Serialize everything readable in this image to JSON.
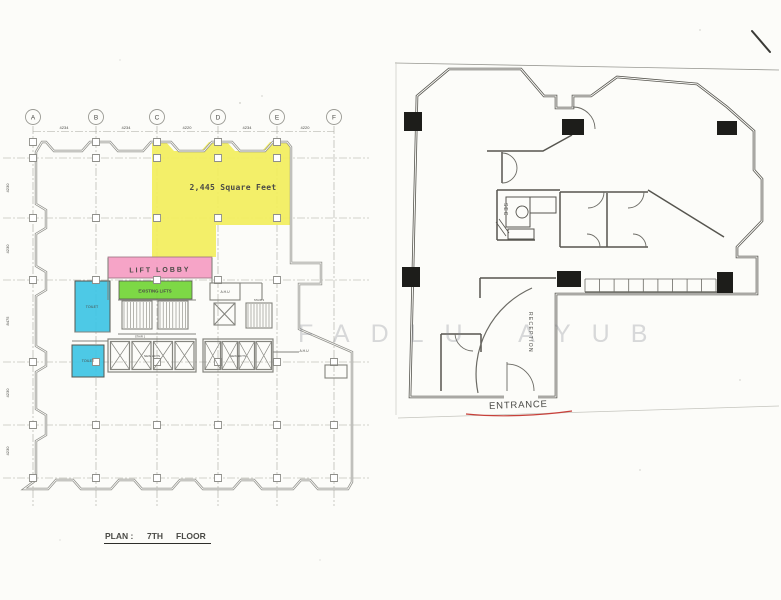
{
  "watermark": "FADLU AYUB",
  "left_plan": {
    "caption_prefix": "PLAN :",
    "caption_floor": "7TH",
    "caption_suffix": "FLOOR",
    "area_label": "2,445 Square Feet",
    "lift_lobby": "LIFT LOBBY",
    "existing_lifts": "EXISTING LIFTS",
    "toilet_upper": "TOILET",
    "toilet_lower": "TOILET",
    "ahu_upper": "A.H.U",
    "ahu_lower": "A.H.U",
    "stair_left": "STAIR 1",
    "stair_right": "STAIR 2",
    "lift_bank_left": "NEW LIFTS",
    "lift_bank_right": "NEW LIFTS",
    "grid_columns": [
      "A",
      "B",
      "C",
      "D",
      "E",
      "F"
    ],
    "top_dims": [
      "4234",
      "4234",
      "4220",
      "4234",
      "4220"
    ],
    "side_dims": [
      "4230",
      "4230",
      "8475",
      "4230",
      "4230"
    ]
  },
  "right_plan": {
    "sec": "SEC",
    "reception": "RECEPTION",
    "entrance": "ENTRANCE"
  },
  "colors": {
    "yellow": "#f2ee5c",
    "pink": "#f59fc4",
    "green": "#76d63c",
    "cyan": "#3ec4e4",
    "red": "#c8403a",
    "wall_gray": "#8f8f8a",
    "wall_dark": "#56554f"
  }
}
